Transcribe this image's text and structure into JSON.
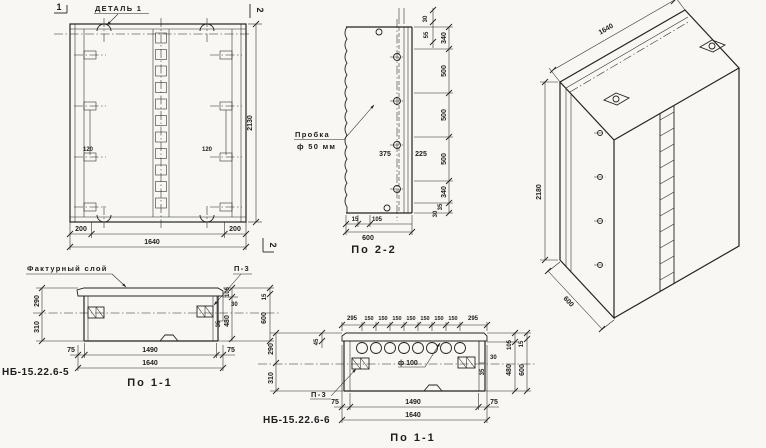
{
  "colors": {
    "ink": "#232323",
    "paper": "#f8f7f3"
  },
  "front_view": {
    "detail_label": "ДЕТАЛЬ 1",
    "cut_mark_1": "1",
    "cut_mark_2_top": "2",
    "cut_mark_2_bottom": "2",
    "dim_height": "2130",
    "dim_120_left": "120",
    "dim_120_right": "120",
    "dim_200_left": "200",
    "dim_width": "1640",
    "dim_200_right": "200"
  },
  "section_2_2": {
    "title": "По 2-2",
    "plug_label_1": "Пробка",
    "plug_label_2": "ф 50 мм",
    "dim_375": "375",
    "dim_225": "225",
    "dim_top_30": "30",
    "dim_top_55": "55",
    "right_chain": [
      "340",
      "500",
      "500",
      "500",
      "340"
    ],
    "dim_bot_35": "35",
    "dim_bot_30": "30",
    "dim_15": "15",
    "dim_105": "105",
    "dim_width": "600"
  },
  "iso_view": {
    "dim_width": "1640",
    "dim_height": "2180",
    "dim_depth": "600"
  },
  "section_1_1_left": {
    "title": "По 1-1",
    "code": "НБ-15.22.6-5",
    "facing_label": "Фактурный слой",
    "plate_label": "П-3",
    "dim_290": "290",
    "dim_310": "310",
    "dim_105": "105",
    "dim_30": "30",
    "dim_35": "35",
    "dim_480": "480",
    "dim_15": "15",
    "dim_600": "600",
    "dim_75_left": "75",
    "dim_1490": "1490",
    "dim_75_right": "75",
    "dim_width": "1640"
  },
  "section_1_1_right": {
    "title": "По 1-1",
    "code": "НБ-15.22.6-6",
    "plate_label": "П-3",
    "hole_label": "ф 100",
    "top_chain": [
      "295",
      "150",
      "150",
      "150",
      "150",
      "150",
      "150",
      "150",
      "295"
    ],
    "dim_45": "45",
    "dim_290": "290",
    "dim_310": "310",
    "dim_30": "30",
    "dim_35": "35",
    "dim_105": "105",
    "dim_15": "15",
    "dim_480": "480",
    "dim_600": "600",
    "dim_75_left": "75",
    "dim_1490": "1490",
    "dim_75_right": "75",
    "dim_width": "1640"
  }
}
